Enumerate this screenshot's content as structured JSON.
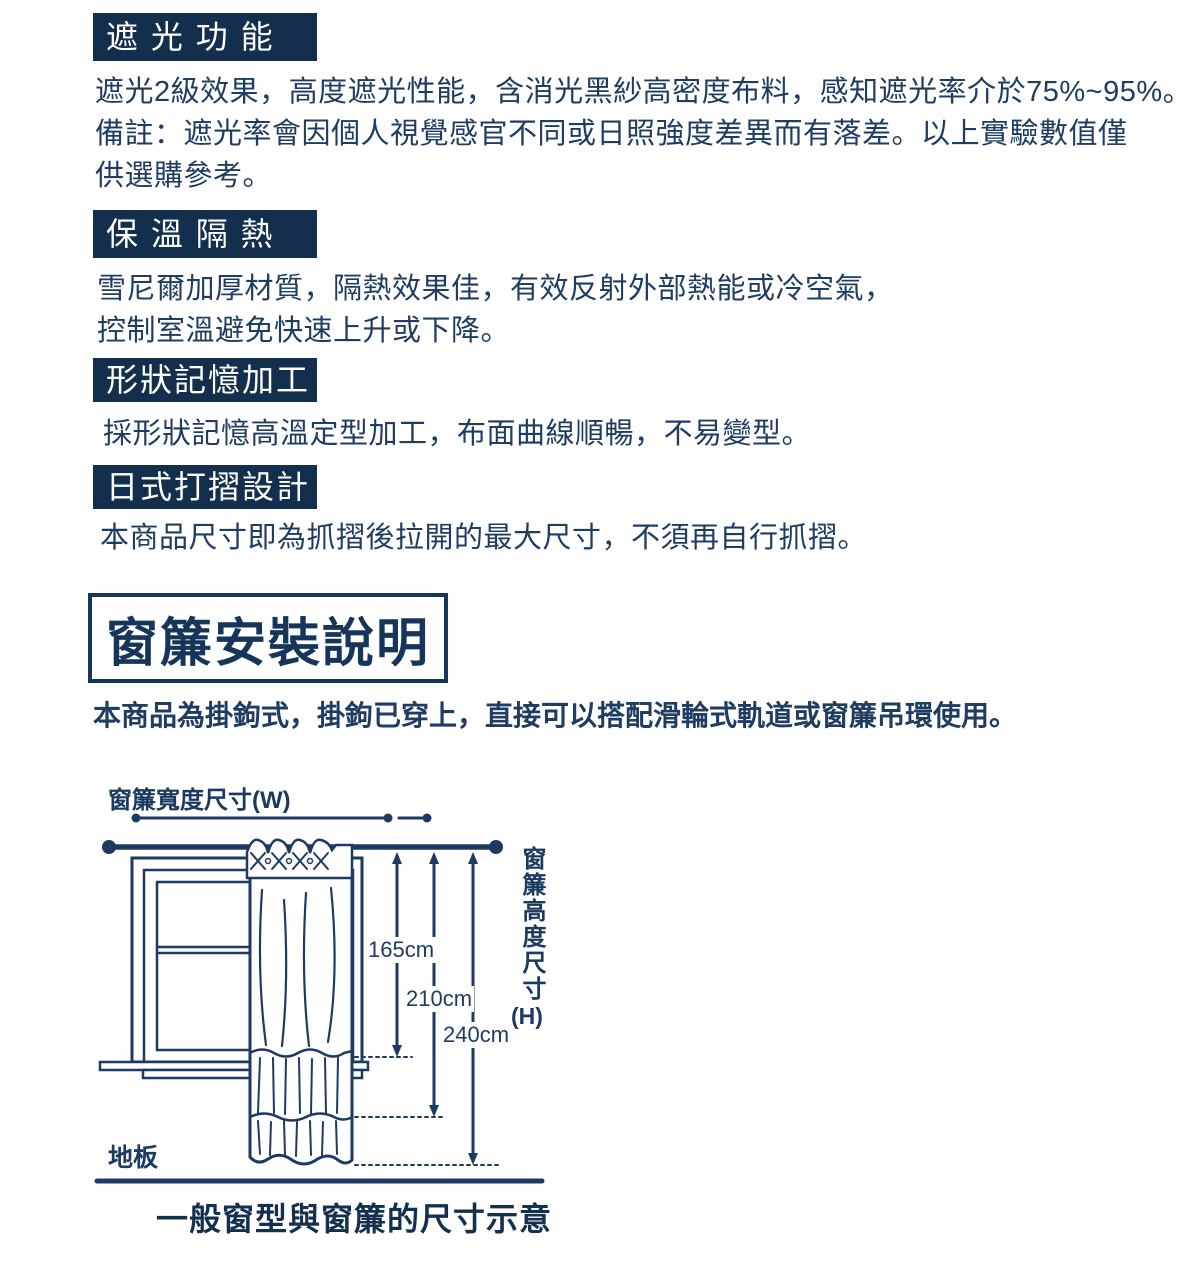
{
  "colors": {
    "header_bar_bg": "#142f4d",
    "body_text": "#1f3c63",
    "diagram_line": "#1e3a62",
    "caption_text": "#14304f",
    "background": "#ffffff"
  },
  "sections": [
    {
      "title": "遮 光 功 能",
      "body": "遮光2級效果，高度遮光性能，含消光黑紗高密度布料，感知遮光率介於75%~95%。\n備註：遮光率會因個人視覺感官不同或日照強度差異而有落差。以上實驗數值僅\n供選購參考。"
    },
    {
      "title": "保 溫 隔 熱",
      "body": "雪尼爾加厚材質，隔熱效果佳，有效反射外部熱能或冷空氣，\n控制室溫避免快速上升或下降。"
    },
    {
      "title": "形狀記憶加工",
      "body": "採形狀記憶高溫定型加工，布面曲線順暢，不易變型。"
    },
    {
      "title": "日式打摺設計",
      "body": "本商品尺寸即為抓摺後拉開的最大尺寸，不須再自行抓摺。"
    }
  ],
  "install": {
    "title": "窗簾安裝說明",
    "description": "本商品為掛鉤式，掛鉤已穿上，直接可以搭配滑輪式軌道或窗簾吊環使用。"
  },
  "diagram": {
    "width_label": "窗簾寬度尺寸(W)",
    "height_label": "窗簾高度尺寸",
    "height_unit": "(H)",
    "measurements": [
      "165cm",
      "210cm",
      "240cm"
    ],
    "floor_label": "地板",
    "caption": "一般窗型與窗簾的尺寸示意"
  }
}
